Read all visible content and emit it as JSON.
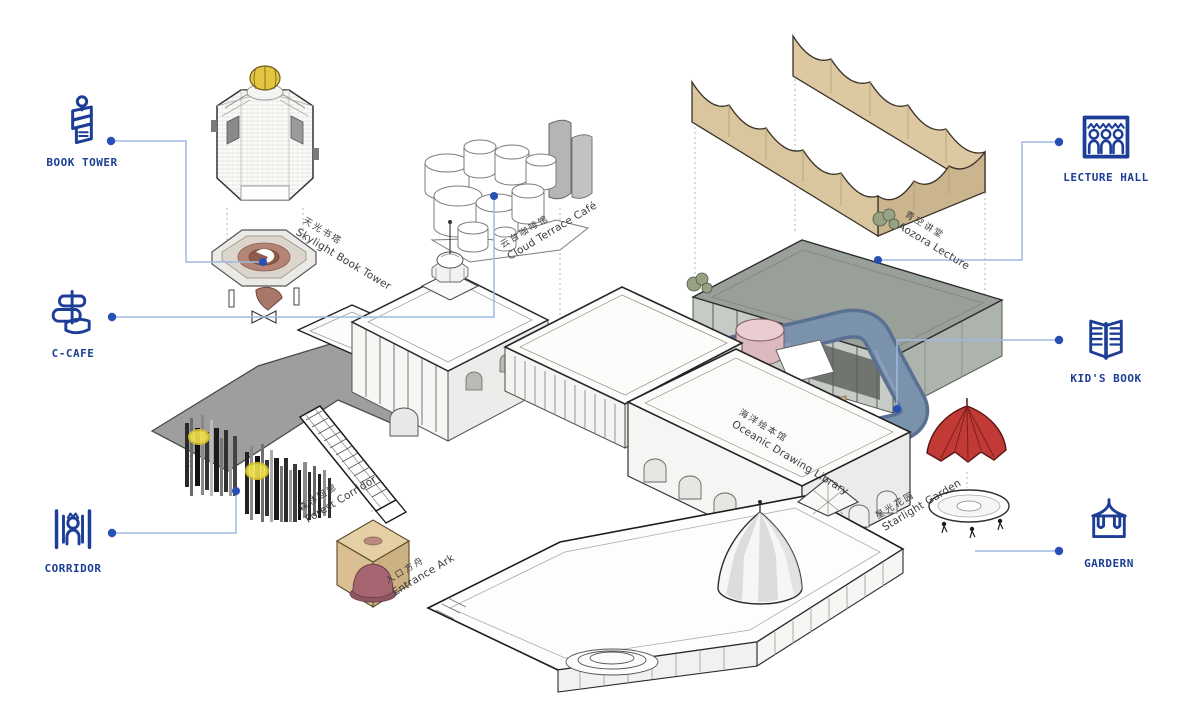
{
  "legend_left": [
    {
      "id": "book-tower",
      "label": "BOOK TOWER"
    },
    {
      "id": "c-cafe",
      "label": "C-CAFE"
    },
    {
      "id": "corridor",
      "label": "CORRIDOR"
    }
  ],
  "legend_right": [
    {
      "id": "lecture-hall",
      "label": "LECTURE HALL"
    },
    {
      "id": "kids-book",
      "label": "KID'S BOOK"
    },
    {
      "id": "gardern",
      "label": "GARDERN"
    }
  ],
  "building_labels": [
    {
      "id": "skylight-book-tower",
      "zh": "天光书塔",
      "en": "Skylight Book Tower"
    },
    {
      "id": "cloud-terrace-cafe",
      "zh": "云台咖啡馆",
      "en": "Cloud Terrace Café"
    },
    {
      "id": "aozora-lecture",
      "zh": "青空讲堂",
      "en": "Aozora Lecture"
    },
    {
      "id": "oceanic-drawing-library",
      "zh": "海洋绘本馆",
      "en": "Oceanic Drawing Library"
    },
    {
      "id": "forest-corridor",
      "zh": "森林回廊",
      "en": "Forest Corridor"
    },
    {
      "id": "entrance-ark",
      "zh": "入口方舟",
      "en": "Entrance Ark"
    },
    {
      "id": "starlight-garden",
      "zh": "星光花园",
      "en": "Starlight Garden"
    }
  ],
  "icons": [
    "book-tower-icon",
    "c-cafe-icon",
    "corridor-icon",
    "lecture-hall-icon",
    "kids-book-icon",
    "gardern-icon"
  ],
  "colors": {
    "accent_blue": "#1d3e96",
    "connector_line": "#9fb9e4",
    "connector_dot": "#2750b4",
    "canopy_tan": "#d9c69e",
    "lecture_roof_gray": "#99a099",
    "ocean_band_blue": "#62799a",
    "tent_red": "#c23a35",
    "dome_yellow": "#e3c53f",
    "ark_tan": "#d6ba88",
    "ark_maroon": "#a56671",
    "ramp_terracotta": "#b48577",
    "plate_gray": "#9e9e9e",
    "slat_dark": "#1f1f1f",
    "label_gray": "#3c3c3c"
  }
}
